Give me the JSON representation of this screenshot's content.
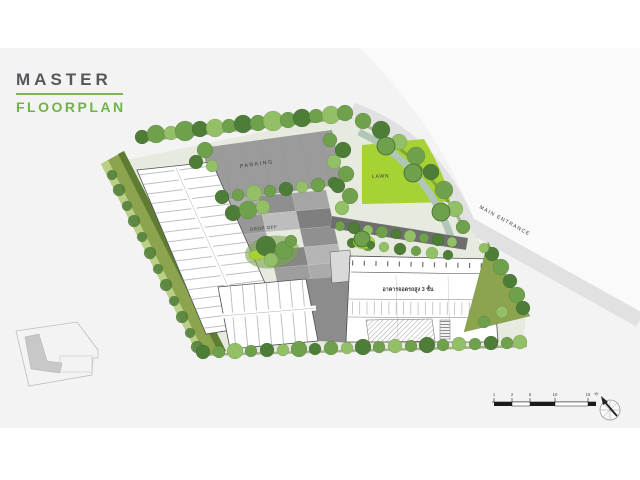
{
  "header": {
    "title_primary": "MASTER",
    "title_secondary": "FLOORPLAN"
  },
  "plan_labels": {
    "parking": "PARKING",
    "lawn": "LAWN",
    "main_entrance": "MAIN ENTRANCE",
    "drop_off": "DROP OFF",
    "parking_building": "อาคารจอดรถสูง 3 ชั้น"
  },
  "scale_bar": {
    "tick_labels": [
      "1",
      "2",
      "5",
      "10",
      "15"
    ]
  },
  "compass": {
    "label": "N"
  },
  "colors": {
    "page": "#ffffff",
    "band": "#f3f3f3",
    "wedge": "#fafafa",
    "road": "#e1e1e1",
    "site-base": "#e7eadf",
    "title-dark": "#56575b",
    "brand-green": "#6fb545",
    "underline-green": "#7fb356",
    "hedge": "#8ba44d",
    "hedge-dark": "#5f7c33",
    "hedge-light": "#bccf86",
    "tree-dark": "#4e7d38",
    "tree-mid": "#6fa04c",
    "tree-light": "#93c066",
    "lawn": "#a6d234",
    "water": "#afc6b9",
    "paving": "#9b9b9b",
    "paving-dark": "#6e6e6e",
    "building-line": "#4e4e4e",
    "label-dark": "#3c3c3c"
  }
}
